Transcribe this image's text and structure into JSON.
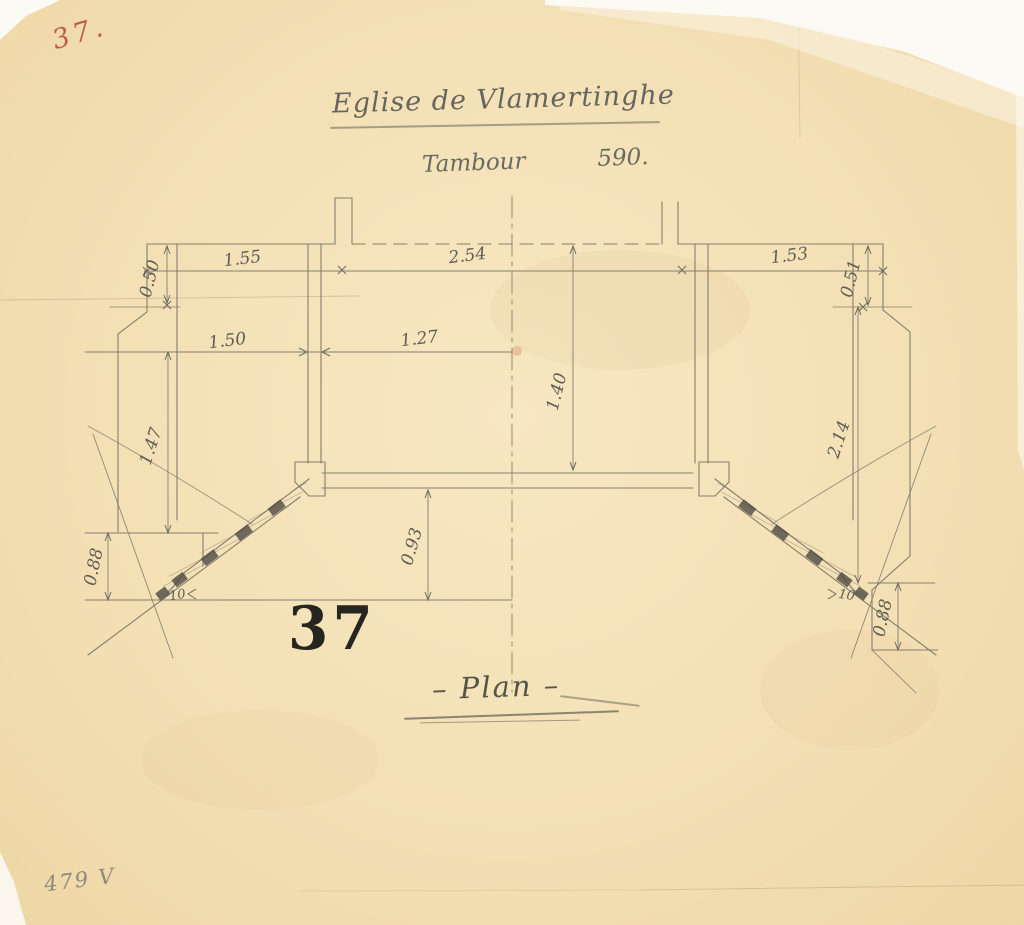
{
  "document": {
    "red_index_note": "37.",
    "title": "Eglise de Vlamertinghe",
    "subtitle_word": "Tambour",
    "subtitle_number": "590.",
    "stamp_number": "37",
    "caption": "– Plan –",
    "archive_note": "479 V"
  },
  "dimensions": {
    "top_left": "1.55",
    "top_center": "2.54",
    "top_right": "1.53",
    "left_jamb_depth": "0.50",
    "right_jamb_depth": "0.51",
    "mid_left_width": "1.50",
    "mid_center_width": "1.27",
    "center_height": "1.40",
    "left_wall_height": "1.47",
    "right_wall_height": "2.14",
    "bottom_left_corner": "0.88",
    "bottom_center_depth": "0.93",
    "bottom_right_corner": "0.88",
    "wall_thickness_left": "10",
    "wall_thickness_right": "10"
  },
  "colors": {
    "paper": "#f3dfb3",
    "pencil": "#867f71",
    "pencil_dark": "#5f5c54",
    "stamp_ink": "#26251f",
    "red_crayon": "#b5473e"
  }
}
